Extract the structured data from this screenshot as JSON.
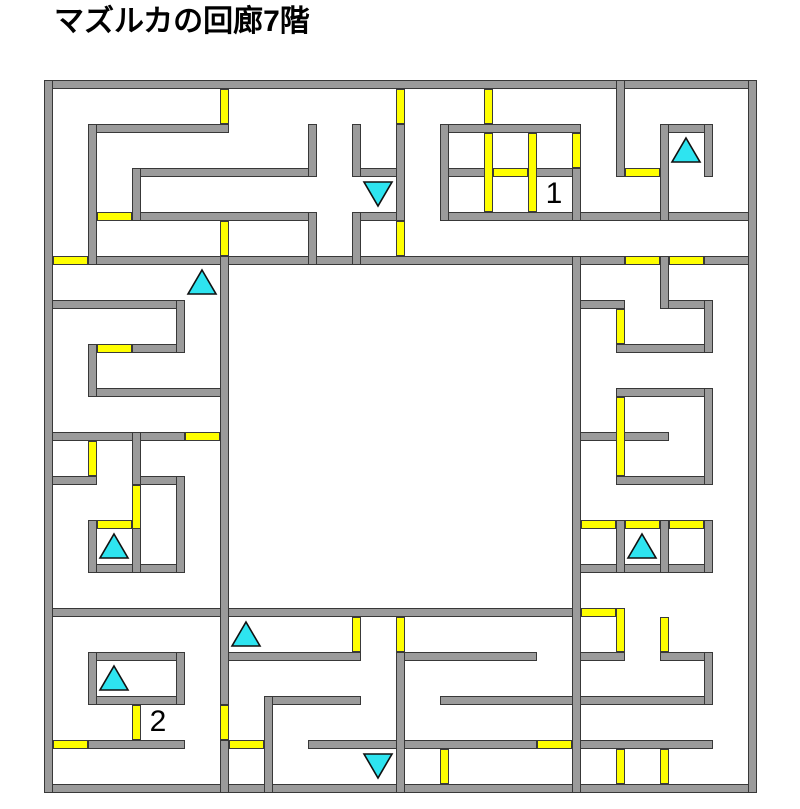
{
  "title": "マズルカの回廊7階",
  "maze": {
    "grid": {
      "cols": 16,
      "rows": 16,
      "origin_x": 48,
      "origin_y": 84,
      "cell": 44,
      "wall_thickness": 9
    },
    "colors": {
      "background": "#ffffff",
      "wall_fill": "#9b9b9b",
      "wall_outline": "#383838",
      "door_fill": "#ffff00",
      "door_outline": "#3a3a3a",
      "stairs_fill": "#2ee4f0",
      "stairs_outline": "#111111",
      "label_color": "#000000",
      "title_color": "#000000"
    },
    "walls_h": [
      {
        "r": 0,
        "c1": 0,
        "c2": 16
      },
      {
        "r": 16,
        "c1": 0,
        "c2": 16
      },
      {
        "r": 1,
        "c1": 1,
        "c2": 4
      },
      {
        "r": 1,
        "c1": 9,
        "c2": 12
      },
      {
        "r": 1,
        "c1": 14,
        "c2": 15
      },
      {
        "r": 2,
        "c1": 2,
        "c2": 6
      },
      {
        "r": 2,
        "c1": 7,
        "c2": 8
      },
      {
        "r": 2,
        "c1": 9,
        "c2": 10
      },
      {
        "r": 2,
        "c1": 11,
        "c2": 12
      },
      {
        "r": 3,
        "c1": 2,
        "c2": 6
      },
      {
        "r": 3,
        "c1": 7,
        "c2": 8
      },
      {
        "r": 3,
        "c1": 9,
        "c2": 16
      },
      {
        "r": 4,
        "c1": 1,
        "c2": 13
      },
      {
        "r": 4,
        "c1": 15,
        "c2": 16
      },
      {
        "r": 5,
        "c1": 0,
        "c2": 3
      },
      {
        "r": 5,
        "c1": 12,
        "c2": 13
      },
      {
        "r": 5,
        "c1": 14,
        "c2": 15
      },
      {
        "r": 6,
        "c1": 2,
        "c2": 3
      },
      {
        "r": 6,
        "c1": 13,
        "c2": 15
      },
      {
        "r": 7,
        "c1": 1,
        "c2": 4
      },
      {
        "r": 7,
        "c1": 13,
        "c2": 15
      },
      {
        "r": 8,
        "c1": 0,
        "c2": 3
      },
      {
        "r": 8,
        "c1": 12,
        "c2": 14
      },
      {
        "r": 9,
        "c1": 0,
        "c2": 1
      },
      {
        "r": 9,
        "c1": 2,
        "c2": 3
      },
      {
        "r": 9,
        "c1": 13,
        "c2": 15
      },
      {
        "r": 11,
        "c1": 1,
        "c2": 3
      },
      {
        "r": 11,
        "c1": 12,
        "c2": 15
      },
      {
        "r": 12,
        "c1": 0,
        "c2": 12
      },
      {
        "r": 13,
        "c1": 1,
        "c2": 3
      },
      {
        "r": 13,
        "c1": 4,
        "c2": 7
      },
      {
        "r": 13,
        "c1": 8,
        "c2": 11
      },
      {
        "r": 13,
        "c1": 12,
        "c2": 13
      },
      {
        "r": 13,
        "c1": 14,
        "c2": 15
      },
      {
        "r": 14,
        "c1": 1,
        "c2": 3
      },
      {
        "r": 14,
        "c1": 5,
        "c2": 7
      },
      {
        "r": 14,
        "c1": 9,
        "c2": 15
      },
      {
        "r": 15,
        "c1": 1,
        "c2": 3
      },
      {
        "r": 15,
        "c1": 6,
        "c2": 11
      },
      {
        "r": 15,
        "c1": 12,
        "c2": 15
      }
    ],
    "walls_v": [
      {
        "c": 0,
        "r1": 0,
        "r2": 16
      },
      {
        "c": 16,
        "r1": 0,
        "r2": 16
      },
      {
        "c": 1,
        "r1": 1,
        "r2": 4
      },
      {
        "c": 2,
        "r1": 2,
        "r2": 3
      },
      {
        "c": 6,
        "r1": 1,
        "r2": 2
      },
      {
        "c": 7,
        "r1": 1,
        "r2": 2
      },
      {
        "c": 8,
        "r1": 1,
        "r2": 3
      },
      {
        "c": 9,
        "r1": 1,
        "r2": 3
      },
      {
        "c": 12,
        "r1": 2,
        "r2": 3
      },
      {
        "c": 13,
        "r1": 0,
        "r2": 2
      },
      {
        "c": 14,
        "r1": 1,
        "r2": 3
      },
      {
        "c": 15,
        "r1": 1,
        "r2": 2
      },
      {
        "c": 6,
        "r1": 3,
        "r2": 4
      },
      {
        "c": 7,
        "r1": 3,
        "r2": 4
      },
      {
        "c": 14,
        "r1": 4,
        "r2": 5
      },
      {
        "c": 15,
        "r1": 5,
        "r2": 6
      },
      {
        "c": 15,
        "r1": 7,
        "r2": 9
      },
      {
        "c": 4,
        "r1": 4,
        "r2": 14
      },
      {
        "c": 4,
        "r1": 15,
        "r2": 16
      },
      {
        "c": 12,
        "r1": 4,
        "r2": 16
      },
      {
        "c": 3,
        "r1": 5,
        "r2": 6
      },
      {
        "c": 1,
        "r1": 6,
        "r2": 7
      },
      {
        "c": 2,
        "r1": 8,
        "r2": 9
      },
      {
        "c": 3,
        "r1": 9,
        "r2": 11
      },
      {
        "c": 1,
        "r1": 10,
        "r2": 11
      },
      {
        "c": 2,
        "r1": 10,
        "r2": 11
      },
      {
        "c": 13,
        "r1": 10,
        "r2": 11
      },
      {
        "c": 14,
        "r1": 10,
        "r2": 11
      },
      {
        "c": 15,
        "r1": 10,
        "r2": 11
      },
      {
        "c": 1,
        "r1": 13,
        "r2": 14
      },
      {
        "c": 3,
        "r1": 13,
        "r2": 14
      },
      {
        "c": 5,
        "r1": 14,
        "r2": 16
      },
      {
        "c": 8,
        "r1": 13,
        "r2": 16
      },
      {
        "c": 15,
        "r1": 13,
        "r2": 14
      }
    ],
    "doors_h": [
      {
        "r": 2,
        "c1": 10,
        "c2": 11
      },
      {
        "r": 2,
        "c1": 13,
        "c2": 14
      },
      {
        "r": 3,
        "c1": 1,
        "c2": 2
      },
      {
        "r": 4,
        "c1": 0,
        "c2": 1
      },
      {
        "r": 4,
        "c1": 13,
        "c2": 14
      },
      {
        "r": 4,
        "c1": 14,
        "c2": 15
      },
      {
        "r": 6,
        "c1": 1,
        "c2": 2
      },
      {
        "r": 8,
        "c1": 3,
        "c2": 4
      },
      {
        "r": 10,
        "c1": 1,
        "c2": 2
      },
      {
        "r": 10,
        "c1": 12,
        "c2": 13
      },
      {
        "r": 10,
        "c1": 13,
        "c2": 14
      },
      {
        "r": 10,
        "c1": 14,
        "c2": 15
      },
      {
        "r": 12,
        "c1": 12,
        "c2": 13
      },
      {
        "r": 15,
        "c1": 0,
        "c2": 1
      },
      {
        "r": 15,
        "c1": 4,
        "c2": 5
      },
      {
        "r": 15,
        "c1": 11,
        "c2": 12
      }
    ],
    "doors_v": [
      {
        "c": 4,
        "r1": 0,
        "r2": 1
      },
      {
        "c": 8,
        "r1": 0,
        "r2": 1
      },
      {
        "c": 10,
        "r1": 0,
        "r2": 1
      },
      {
        "c": 10,
        "r1": 1,
        "r2": 3
      },
      {
        "c": 11,
        "r1": 1,
        "r2": 3
      },
      {
        "c": 12,
        "r1": 1,
        "r2": 2
      },
      {
        "c": 4,
        "r1": 3,
        "r2": 4
      },
      {
        "c": 8,
        "r1": 3,
        "r2": 4
      },
      {
        "c": 13,
        "r1": 5,
        "r2": 6
      },
      {
        "c": 13,
        "r1": 7,
        "r2": 9
      },
      {
        "c": 1,
        "r1": 8,
        "r2": 9
      },
      {
        "c": 2,
        "r1": 9,
        "r2": 10,
        "x2": true
      },
      {
        "c": 7,
        "r1": 12,
        "r2": 13
      },
      {
        "c": 8,
        "r1": 12,
        "r2": 13
      },
      {
        "c": 13,
        "r1": 12,
        "r2": 13,
        "x1": true
      },
      {
        "c": 14,
        "r1": 12,
        "r2": 13
      },
      {
        "c": 2,
        "r1": 14,
        "r2": 15
      },
      {
        "c": 4,
        "r1": 14,
        "r2": 15
      },
      {
        "c": 9,
        "r1": 15,
        "r2": 16
      },
      {
        "c": 13,
        "r1": 15,
        "r2": 16
      },
      {
        "c": 14,
        "r1": 15,
        "r2": 16
      }
    ],
    "stairs": [
      {
        "cell": [
          14,
          1
        ],
        "dir": "up"
      },
      {
        "cell": [
          7,
          2
        ],
        "dir": "down"
      },
      {
        "cell": [
          3,
          4
        ],
        "dir": "up"
      },
      {
        "cell": [
          1,
          10
        ],
        "dir": "up"
      },
      {
        "cell": [
          13,
          10
        ],
        "dir": "up"
      },
      {
        "cell": [
          4,
          12
        ],
        "dir": "up"
      },
      {
        "cell": [
          1,
          13
        ],
        "dir": "up"
      },
      {
        "cell": [
          7,
          15
        ],
        "dir": "down"
      }
    ],
    "labels": [
      {
        "cell": [
          11,
          2
        ],
        "text": "1"
      },
      {
        "cell": [
          2,
          14
        ],
        "text": "2"
      }
    ]
  }
}
